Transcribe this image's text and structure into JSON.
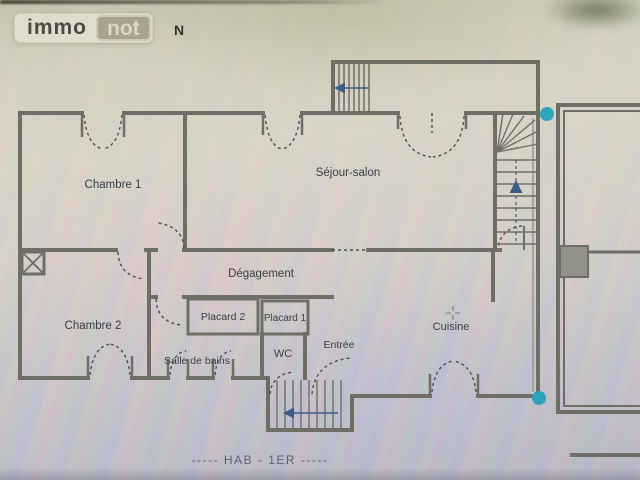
{
  "logo": {
    "immo": "immo",
    "not": "not"
  },
  "compass": {
    "north_label": "N"
  },
  "rooms": {
    "chambre1": "Chambre 1",
    "sejour": "Séjour-salon",
    "degagement": "Dégagement",
    "chambre2": "Chambre 2",
    "placard2": "Placard 2",
    "placard1": "Placard 1",
    "salle_de_bains": "Salle de bains",
    "wc": "WC",
    "entree": "Entrée",
    "cuisine": "Cuisine"
  },
  "caption": {
    "floor": "-----  HAB - 1ER  -----"
  },
  "colors": {
    "wall": "#6f6e66",
    "marker_dot": "#2ba4bc",
    "stair_arrow": "#3d5c85",
    "label_text": "#3a3d45"
  },
  "icons": {
    "stair_up_arrow": "triangle-up",
    "stair_left_arrow": "triangle-left",
    "column_symbol": "crossed-box",
    "center_mark": "crosshair"
  },
  "markers": {
    "count": 2
  }
}
